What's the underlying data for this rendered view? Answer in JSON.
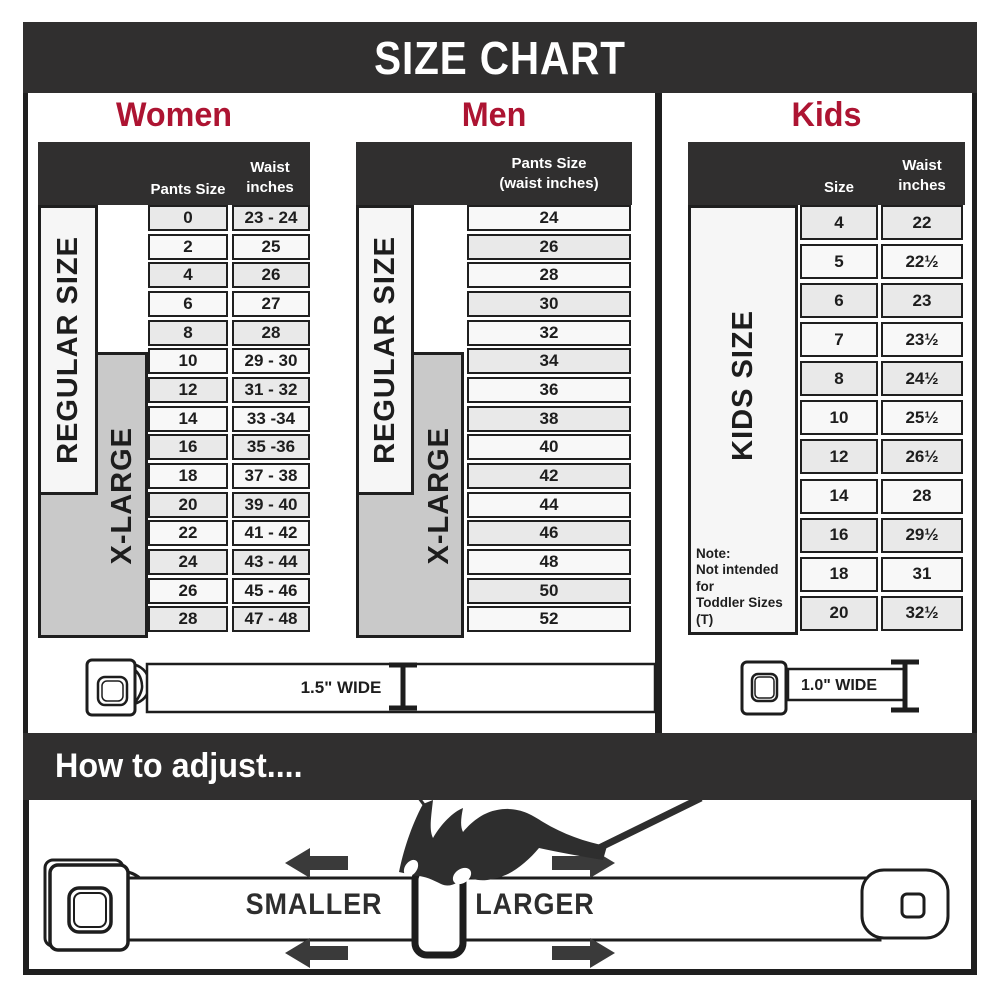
{
  "title": "SIZE CHART",
  "sections": {
    "women": {
      "title": "Women",
      "regular_label": "REGULAR SIZE",
      "xlarge_label": "X-LARGE",
      "header": {
        "col1": "Pants Size",
        "col2_line1": "Waist",
        "col2_line2": "inches"
      },
      "rows": [
        {
          "size": "0",
          "waist": "23 - 24"
        },
        {
          "size": "2",
          "waist": "25"
        },
        {
          "size": "4",
          "waist": "26"
        },
        {
          "size": "6",
          "waist": "27"
        },
        {
          "size": "8",
          "waist": "28"
        },
        {
          "size": "10",
          "waist": "29 - 30"
        },
        {
          "size": "12",
          "waist": "31 - 32"
        },
        {
          "size": "14",
          "waist": "33 -34"
        },
        {
          "size": "16",
          "waist": "35 -36"
        },
        {
          "size": "18",
          "waist": "37 - 38"
        },
        {
          "size": "20",
          "waist": "39 - 40"
        },
        {
          "size": "22",
          "waist": "41 - 42"
        },
        {
          "size": "24",
          "waist": "43 - 44"
        },
        {
          "size": "26",
          "waist": "45 - 46"
        },
        {
          "size": "28",
          "waist": "47 - 48"
        }
      ]
    },
    "men": {
      "title": "Men",
      "regular_label": "REGULAR SIZE",
      "xlarge_label": "X-LARGE",
      "header": {
        "line1": "Pants Size",
        "line2": "(waist inches)"
      },
      "rows": [
        "24",
        "26",
        "28",
        "30",
        "32",
        "34",
        "36",
        "38",
        "40",
        "42",
        "44",
        "46",
        "48",
        "50",
        "52"
      ]
    },
    "kids": {
      "title": "Kids",
      "size_label": "KIDS SIZE",
      "header": {
        "col1": "Size",
        "col2_line1": "Waist",
        "col2_line2": "inches"
      },
      "rows": [
        {
          "size": "4",
          "waist": "22"
        },
        {
          "size": "5",
          "waist": "22½"
        },
        {
          "size": "6",
          "waist": "23"
        },
        {
          "size": "7",
          "waist": "23½"
        },
        {
          "size": "8",
          "waist": "24½"
        },
        {
          "size": "10",
          "waist": "25½"
        },
        {
          "size": "12",
          "waist": "26½"
        },
        {
          "size": "14",
          "waist": "28"
        },
        {
          "size": "16",
          "waist": "29½"
        },
        {
          "size": "18",
          "waist": "31"
        },
        {
          "size": "20",
          "waist": "32½"
        }
      ],
      "note_line1": "Note:",
      "note_line2": "Not intended for",
      "note_line3": "Toddler Sizes (T)"
    }
  },
  "belts": {
    "adult_width_label": "1.5\" WIDE",
    "kids_width_label": "1.0\" WIDE"
  },
  "adjust": {
    "banner": "How to adjust....",
    "smaller_label": "SMALLER",
    "larger_label": "LARGER"
  },
  "colors": {
    "accent_red": "#ad1432",
    "banner_dark": "#302f2f",
    "row_light": "#f8f8f8",
    "row_shaded": "#e9e9e9",
    "xlarge_gray": "#c9c9c9",
    "ink": "#1f1f1f"
  }
}
